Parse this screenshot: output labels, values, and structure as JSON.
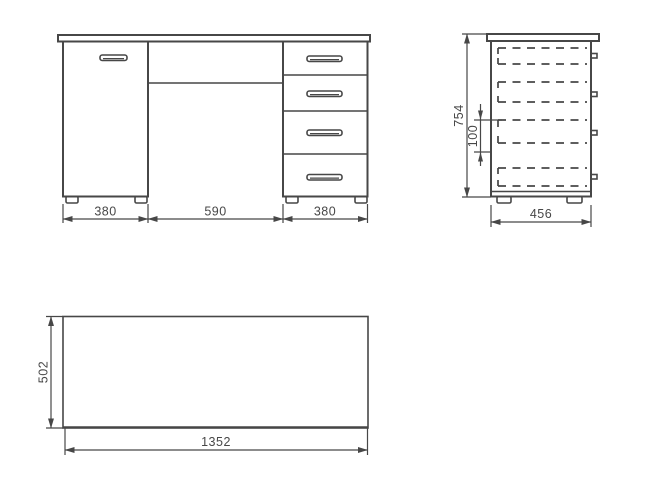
{
  "colors": {
    "line": "#474747",
    "background": "#ffffff"
  },
  "front_view": {
    "dims": {
      "left": "380",
      "center": "590",
      "right": "380"
    }
  },
  "side_view": {
    "dims": {
      "height": "754",
      "drawer_pitch": "100",
      "depth": "456"
    }
  },
  "top_view": {
    "dims": {
      "depth": "502",
      "width": "1352"
    }
  }
}
